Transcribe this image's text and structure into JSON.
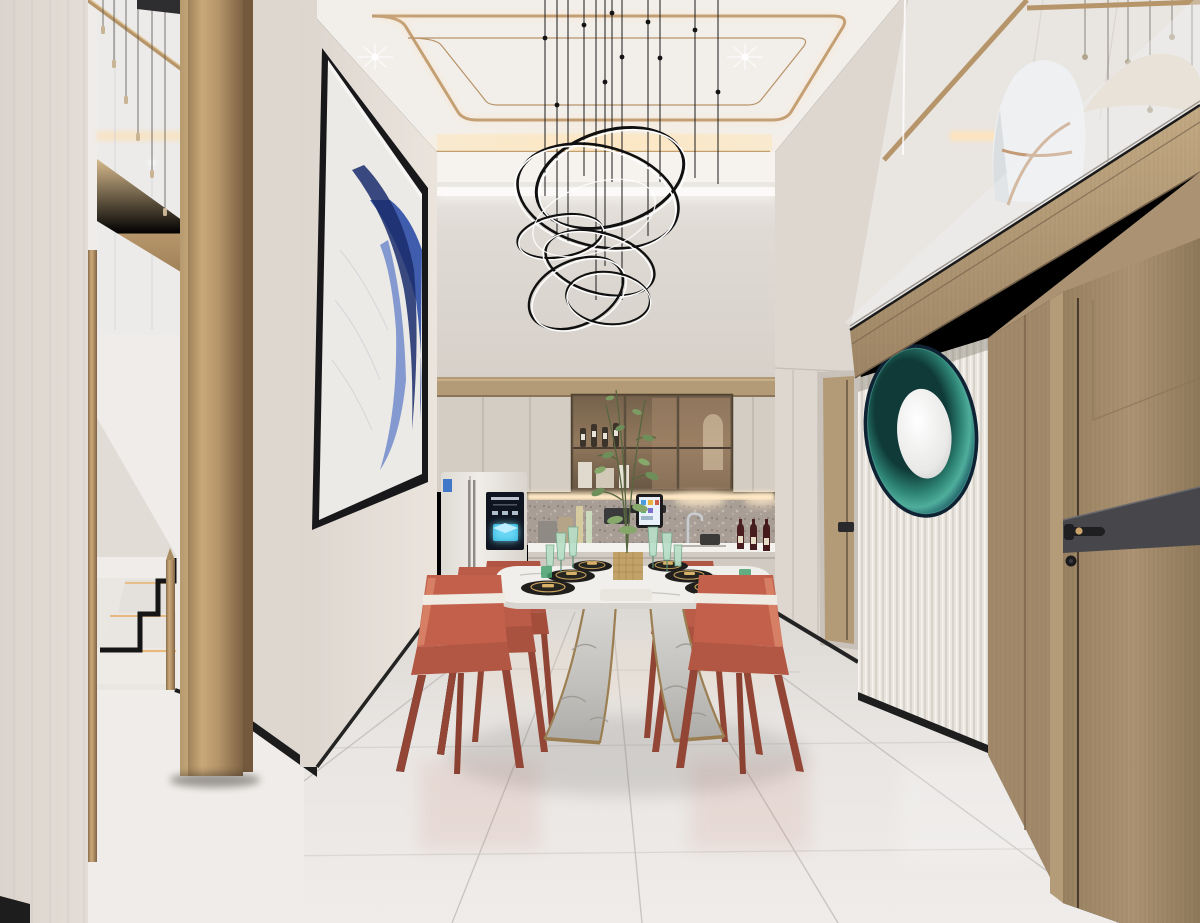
{
  "scene": {
    "type": "interior-architectural-render",
    "room": "double-height dining room with open kitchen, gold stair column, mezzanine and smart fridge",
    "style": "modern light-luxury, cream / gold / terracotta",
    "objects": [
      "ring-chandelier",
      "dining-table-marble",
      "terracotta-dining-chairs",
      "abstract-blue-artwork",
      "gold-column",
      "marble-staircase",
      "stair-pendant-lights",
      "kitchen-cabinets",
      "glass-display-cabinet",
      "smart-refrigerator",
      "wall-tablet",
      "wine-bottles",
      "centerpiece-plant",
      "peacock-round-mirror",
      "fluted-wall-panel",
      "wood-entry-door",
      "mezzanine-glass-railing",
      "white-lounge-chair",
      "cove-lit-ceiling",
      "glossy-marble-floor"
    ]
  },
  "palette": {
    "gold": "#b6956a",
    "goldLight": "#dcc095",
    "goldDark": "#8a6e4c",
    "wall": "#e2dcd5",
    "wallDim": "#d3ccc5",
    "ceiling": "#f3f0ec",
    "glow": "#ffd9a8",
    "chair": "#c2604b",
    "chairLight": "#d67f64",
    "chairDark": "#97412f",
    "artBlue": "#2e4ea6",
    "artBlueDark": "#1a2c6b",
    "mirrorTeal": "#2c7f6f",
    "mirrorCyan": "#5fc0ad",
    "mirrorNavy": "#0e2233",
    "wood": "#a78e6d",
    "woodDark": "#8d7557",
    "doorBand": "#47474b",
    "floor": "#e7e4e1",
    "marbleBase": "#c7c5c1",
    "tableTop": "#f1efeb",
    "backsplash": "#a89e95",
    "screenBlue": "#35c8f0",
    "screenDark": "#0e1420",
    "plantGreen": "#6f8f5a",
    "glassGreen": "#b9dfc9",
    "black": "#161616"
  },
  "counts": {
    "dining_chairs": 6,
    "chandelier_rings": 7,
    "place_settings": 6,
    "counter_wine_bottles": 3,
    "stair_pendants": 6,
    "ceiling_spotlights": 2
  }
}
